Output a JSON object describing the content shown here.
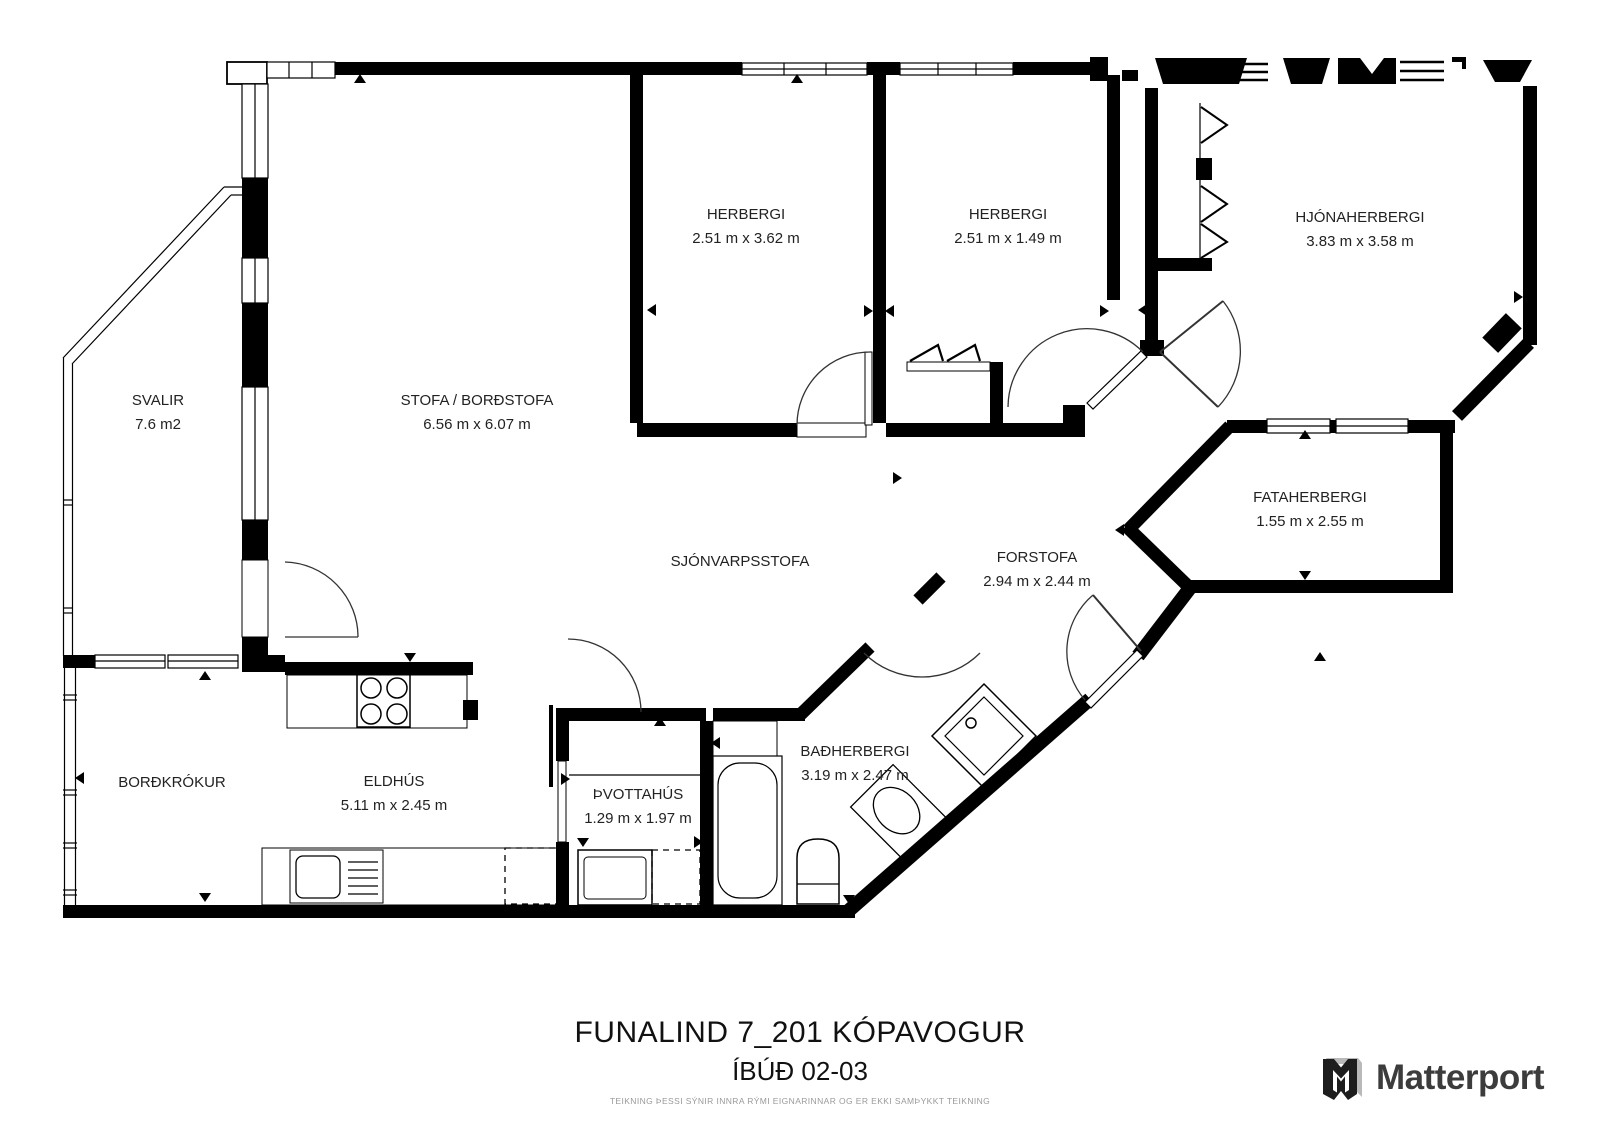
{
  "title": "FUNALIND 7_201 KÓPAVOGUR",
  "subtitle": "ÍBÚÐ 02-03",
  "disclaimer": "TEIKNING ÞESSI SÝNIR INNRA RÝMI EIGNARINNAR OG ER EKKI SAMÞYKKT TEIKNING",
  "brand": {
    "name": "Matterport"
  },
  "colors": {
    "wall": "#000000",
    "background": "#ffffff",
    "text": "#222222",
    "brand_text": "#3c3c3c"
  },
  "rooms": [
    {
      "id": "svalir",
      "label": "SVALIR",
      "dims": "7.6 m2"
    },
    {
      "id": "stofa",
      "label": "STOFA / BORÐSTOFA",
      "dims": "6.56 m x 6.07 m"
    },
    {
      "id": "herbergi-1",
      "label": "HERBERGI",
      "dims": "2.51 m x 3.62 m"
    },
    {
      "id": "herbergi-2",
      "label": "HERBERGI",
      "dims": "2.51 m x 1.49 m"
    },
    {
      "id": "hjonaherbergi",
      "label": "HJÓNAHERBERGI",
      "dims": "3.83 m x 3.58 m"
    },
    {
      "id": "fataherbergi",
      "label": "FATAHERBERGI",
      "dims": "1.55 m x 2.55 m"
    },
    {
      "id": "sjonvarpsstofa",
      "label": "SJÓNVARPSSTOFA",
      "dims": ""
    },
    {
      "id": "forstofa",
      "label": "FORSTOFA",
      "dims": "2.94 m x 2.44 m"
    },
    {
      "id": "bordkrokur",
      "label": "BORÐKRÓKUR",
      "dims": ""
    },
    {
      "id": "eldhus",
      "label": "ELDHÚS",
      "dims": "5.11 m x 2.45 m"
    },
    {
      "id": "thvottahus",
      "label": "ÞVOTTAHÚS",
      "dims": "1.29 m x 1.97 m"
    },
    {
      "id": "badherbergi",
      "label": "BAÐHERBERGI",
      "dims": "3.19 m x 2.47 m"
    }
  ],
  "icons": [
    "stove-icon",
    "kitchen-sink-icon",
    "dishwasher-icon",
    "washing-machine-icon",
    "bathtub-icon",
    "toilet-icon",
    "shower-icon",
    "wardrobe-icon",
    "closet-icon",
    "door-arc-icon",
    "window-icon",
    "direction-arrow-icon",
    "matterport-logo"
  ]
}
